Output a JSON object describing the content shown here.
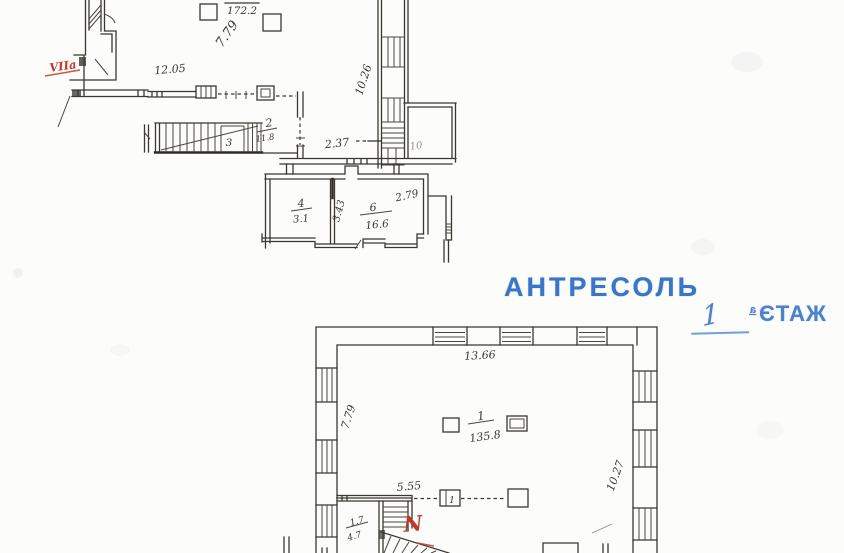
{
  "titles": {
    "antresol": "АНТРЕСОЛЬ",
    "floor_number": "1",
    "floor_word_mirrored": "ЖАТЭ",
    "floor_word_sup": "а"
  },
  "mezzanine": {
    "dim_diag_left": "7.79",
    "dim_top": "12.05",
    "area_top": "172.2",
    "room2_num": "2",
    "room2_area": "11.8",
    "stair_label": "3",
    "dim_mid": "2.37",
    "room4_num": "4",
    "room4_area": "3.1",
    "dim_partition": "3.43",
    "room6_num": "6",
    "room6_area": "16.6",
    "dim_room6": "2.79",
    "dim_right": "10.26",
    "room10": "10",
    "red_mark": "VIIа"
  },
  "first_floor": {
    "dim_top": "13.66",
    "dim_left": "7.79",
    "dim_right": "10.27",
    "room1_num": "1",
    "room1_area": "135.8",
    "dim_wall": "5.55",
    "dim_stair_top": "1.7",
    "dim_stair_bottom": "4.7",
    "red_mark": "N",
    "door_label": "1"
  },
  "colors": {
    "print_blue": "#3a75c7",
    "ink_blue": "#4d82cb",
    "red": "#c0392f",
    "ink": "#35332d"
  }
}
